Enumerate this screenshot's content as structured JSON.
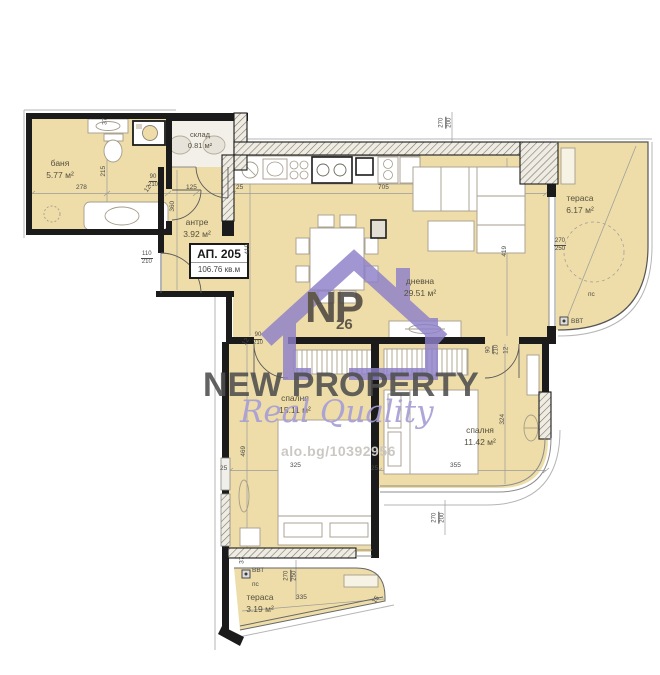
{
  "unit": {
    "id": "АП. 205",
    "area": "106.76 кв.м"
  },
  "rooms": {
    "bathroom": {
      "name": "баня",
      "area": "5.77 м²"
    },
    "storage": {
      "name": "склад",
      "area": "0.81 м²"
    },
    "hallway": {
      "name": "антре",
      "area": "3.92 м²"
    },
    "living": {
      "name": "дневна",
      "area": "29.51 м²"
    },
    "terrace_right": {
      "name": "тераса",
      "area": "6.17 м²"
    },
    "bedroom1": {
      "name": "спалня",
      "area": "15.11 м²"
    },
    "bedroom2": {
      "name": "спалня",
      "area": "11.42 м²"
    },
    "terrace_bottom": {
      "name": "тераса",
      "area": "3.19 м²"
    }
  },
  "dims": {
    "d12": "12",
    "d15": "15",
    "d25": "25",
    "d37": "37",
    "d90": "90",
    "d110": "110",
    "d125": "125",
    "d200": "200",
    "d210": "210",
    "d215": "215",
    "d250": "250",
    "d270": "270",
    "d278": "278",
    "d324": "324",
    "d325": "325",
    "d335": "335",
    "d355": "355",
    "d360": "360",
    "d419": "419",
    "d469": "469",
    "d705": "705"
  },
  "annotations": {
    "ps": "пс",
    "vvt": "ВВТ"
  },
  "watermark": {
    "logo": "NP",
    "logo_sub": "26",
    "brand": "NEW PROPERTY",
    "tagline": "Real Quality",
    "listing": "alo.bg/10392956"
  },
  "colors": {
    "room_fill": "#eedda8",
    "wall": "#1b1b1b",
    "watermark_purple": "#8d80c9",
    "brand_gray": "#4e4e4e",
    "tagline_purple": "#a89fd6",
    "listing_gray": "#cbc8c4"
  }
}
